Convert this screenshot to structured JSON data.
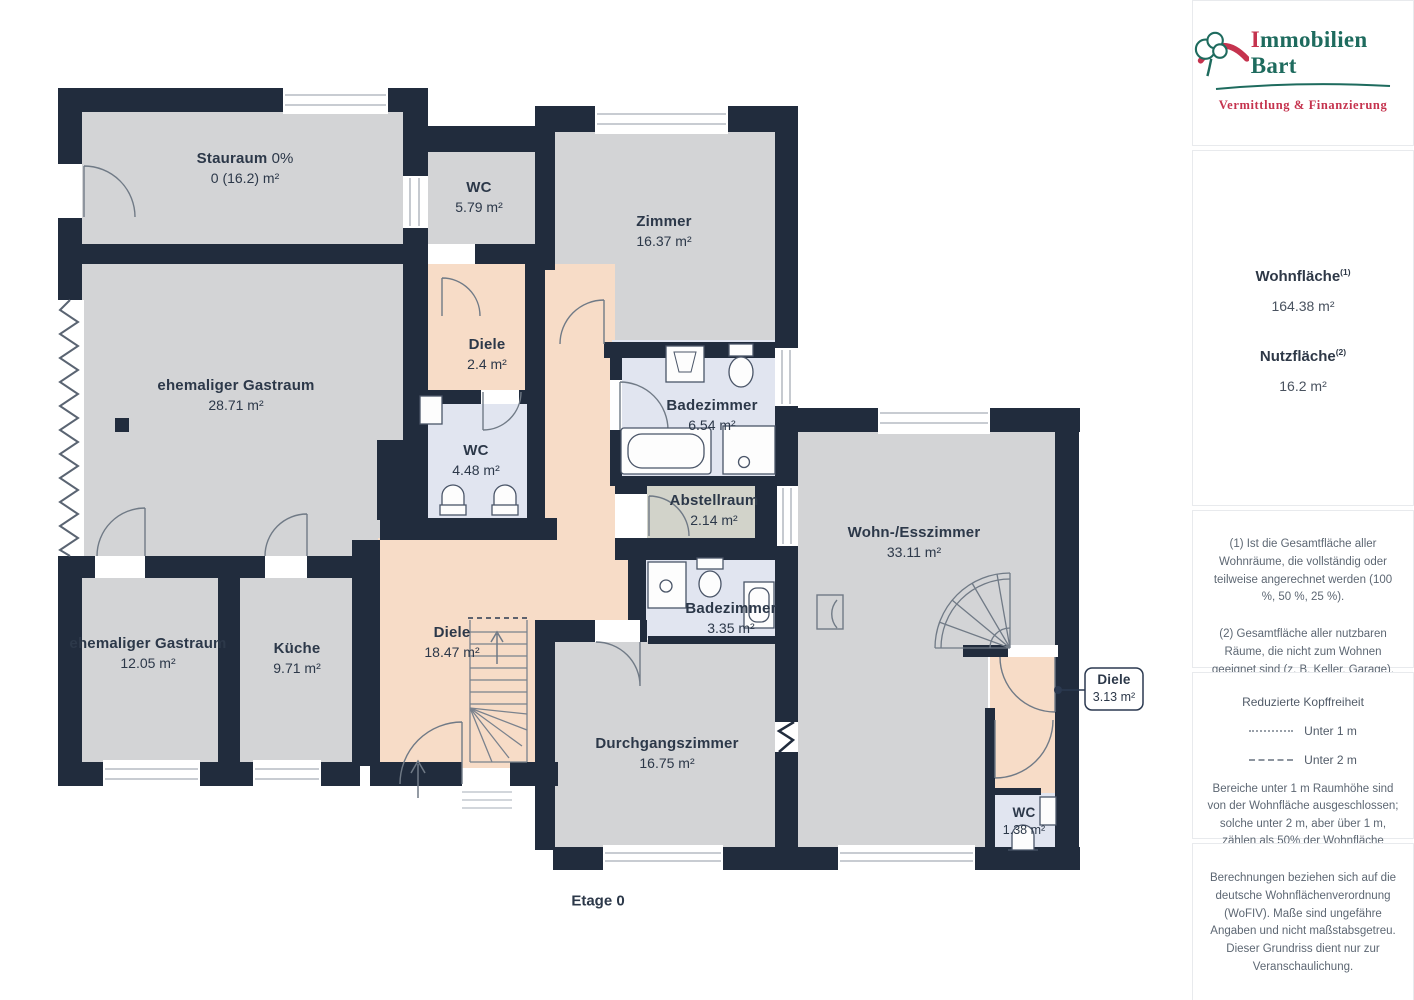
{
  "floorplan": {
    "floor_label": "Etage 0",
    "rooms": [
      {
        "name": "Stauraum",
        "suffix": " 0%",
        "area": "0 (16.2) m²"
      },
      {
        "name": "WC",
        "area": "5.79 m²"
      },
      {
        "name": "Zimmer",
        "area": "16.37 m²"
      },
      {
        "name": "Diele",
        "area": "2.4 m²"
      },
      {
        "name": "ehemaliger Gastraum",
        "area": "28.71 m²"
      },
      {
        "name": "WC",
        "area": "4.48 m²"
      },
      {
        "name": "Badezimmer",
        "area": "6.54 m²"
      },
      {
        "name": "Abstellraum",
        "area": "2.14 m²"
      },
      {
        "name": "ehemaliger Gastraum",
        "area": "12.05 m²"
      },
      {
        "name": "Küche",
        "area": "9.71 m²"
      },
      {
        "name": "Diele",
        "area": "18.47 m²"
      },
      {
        "name": "Badezimmer",
        "area": "3.35 m²"
      },
      {
        "name": "Durchgangszimmer",
        "area": "16.75 m²"
      },
      {
        "name": "Wohn-/Esszimmer",
        "area": "33.11 m²"
      },
      {
        "name": "Diele",
        "area": "3.13 m²"
      },
      {
        "name": "WC",
        "area": "1.38 m²"
      }
    ]
  },
  "sidebar": {
    "logo": {
      "title_first": "I",
      "title_rest": "mmobilien Bart",
      "subtitle": "Vermittlung & Finanzierung"
    },
    "areas": [
      {
        "label": "Wohnfläche",
        "sup": "(1)",
        "value": "164.38 m²"
      },
      {
        "label": "Nutzfläche",
        "sup": "(2)",
        "value": "16.2 m²"
      }
    ],
    "notes": [
      "(1) Ist die Gesamtfläche aller Wohnräume, die vollständig oder teilweise angerechnet werden (100 %, 50 %, 25 %).",
      "(2) Gesamtfläche aller nutzbaren Räume, die nicht zum Wohnen geeignet sind (z. B. Keller, Garage)."
    ],
    "legend": {
      "title": "Reduzierte Kopffreiheit",
      "items": [
        {
          "style": "dotted",
          "label": "Unter 1 m"
        },
        {
          "style": "dashed",
          "label": "Unter 2 m"
        }
      ],
      "description": "Bereiche unter 1 m Raumhöhe sind von der Wohnfläche ausgeschlossen; solche unter 2 m, aber über 1 m, zählen als 50% der Wohnfläche"
    },
    "disclaimer": "Berechnungen beziehen sich auf die deutsche Wohnflächenverordnung (WoFIV). Maße sind ungefähre Angaben und nicht maßstabsgetreu. Dieser Grundriss dient nur zur Veranschaulichung.",
    "brand": {
      "name": "GIRAFFE",
      "suffix": "360"
    }
  },
  "colors": {
    "wall": "#212c3d",
    "room": "#d3d4d6",
    "hall": "#f7dcc7",
    "bath": "#e1e5f0",
    "storage": "#d2d3ca",
    "logo_green": "#1e6b5e",
    "logo_red": "#c5334e"
  }
}
